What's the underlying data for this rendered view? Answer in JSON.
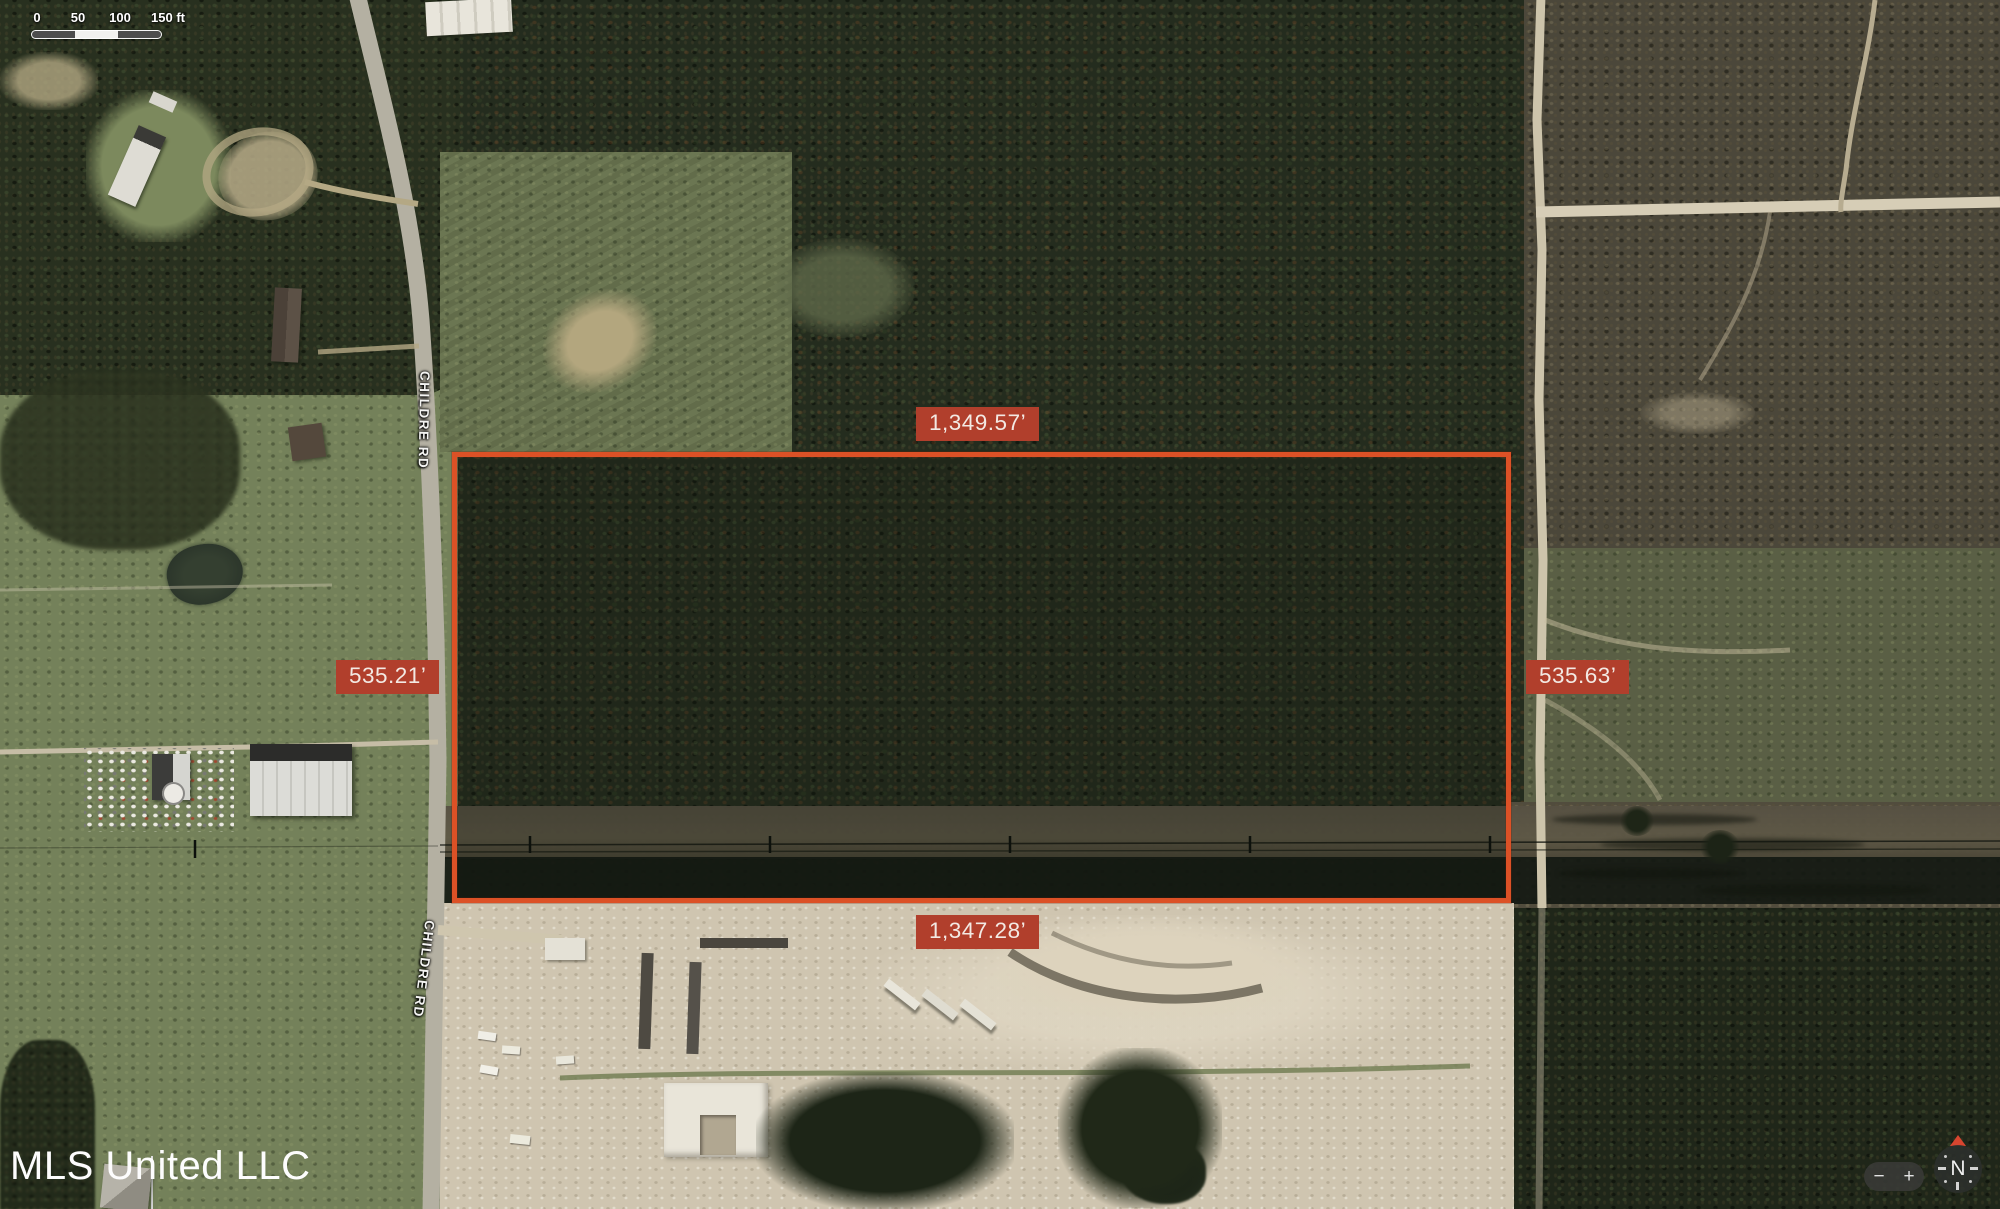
{
  "map": {
    "watermark": "MLS United LLC",
    "road_labels": {
      "upper": "CHILDRE RD",
      "lower": "CHILDRE RD"
    }
  },
  "scale_bar": {
    "ticks": [
      "0",
      "50",
      "100",
      "150 ft"
    ]
  },
  "parcel_dimensions": {
    "top": "1,349.57’",
    "bottom": "1,347.28’",
    "left": "535.21’",
    "right": "535.63’",
    "outline_color": "#dc5126",
    "label_background": "#b13f2c"
  },
  "controls": {
    "zoom_out_label": "−",
    "zoom_in_label": "+",
    "compass_label": "N"
  }
}
